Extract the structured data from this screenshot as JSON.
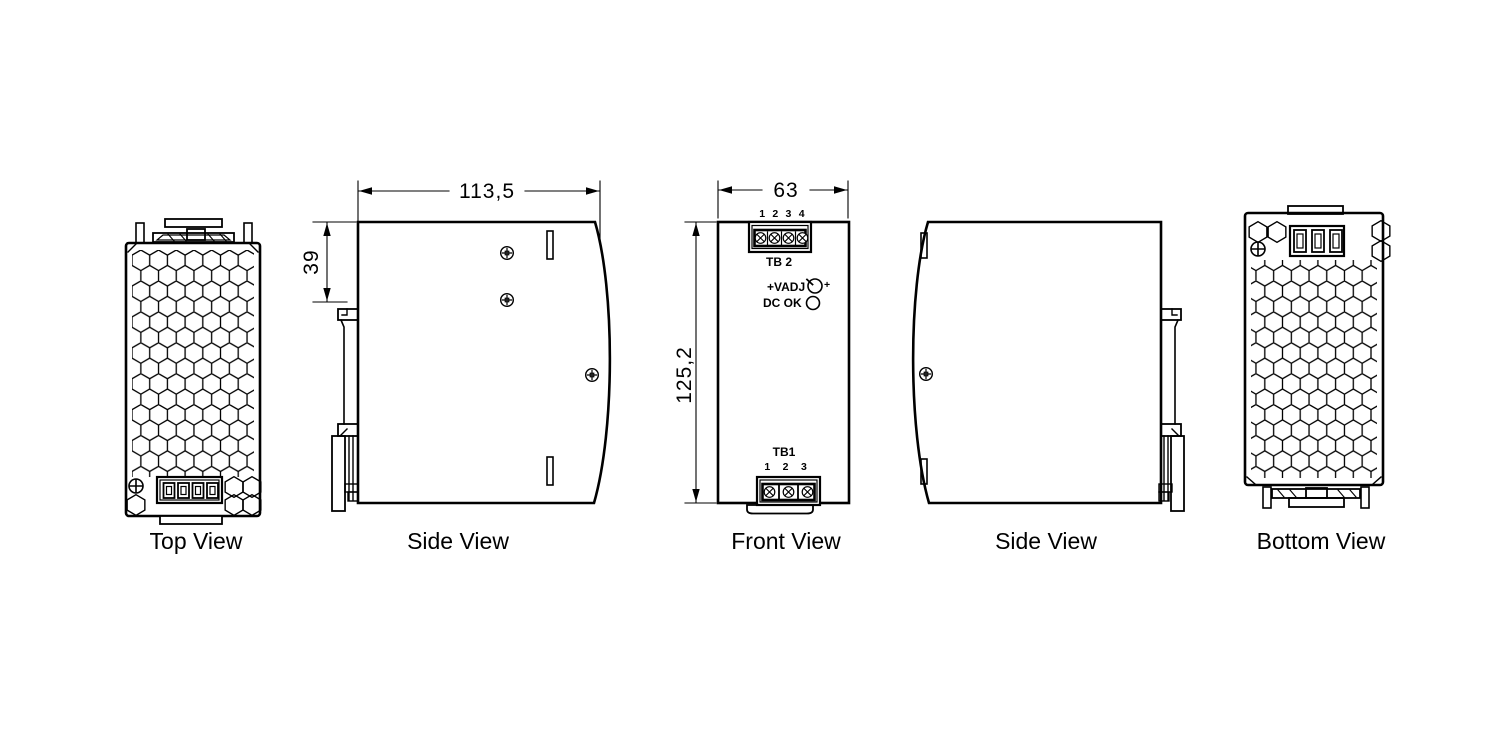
{
  "colors": {
    "background": "#ffffff",
    "line": "#000000"
  },
  "views": {
    "top": {
      "label": "Top View"
    },
    "side_left": {
      "label": "Side View"
    },
    "front": {
      "label": "Front View"
    },
    "side_right": {
      "label": "Side View"
    },
    "bottom": {
      "label": "Bottom View"
    }
  },
  "dimensions": {
    "body_depth": "113,5",
    "clip_offset": "39",
    "body_width": "63",
    "body_height": "125,2"
  },
  "front_panel": {
    "tb2_pins": "1 2 3 4",
    "tb2_label": "TB 2",
    "vadj_label": "+VADJ",
    "vadj_plus": "+",
    "dcok_label": "DC OK",
    "tb1_label": "TB1",
    "tb1_pins": "1 2 3"
  }
}
